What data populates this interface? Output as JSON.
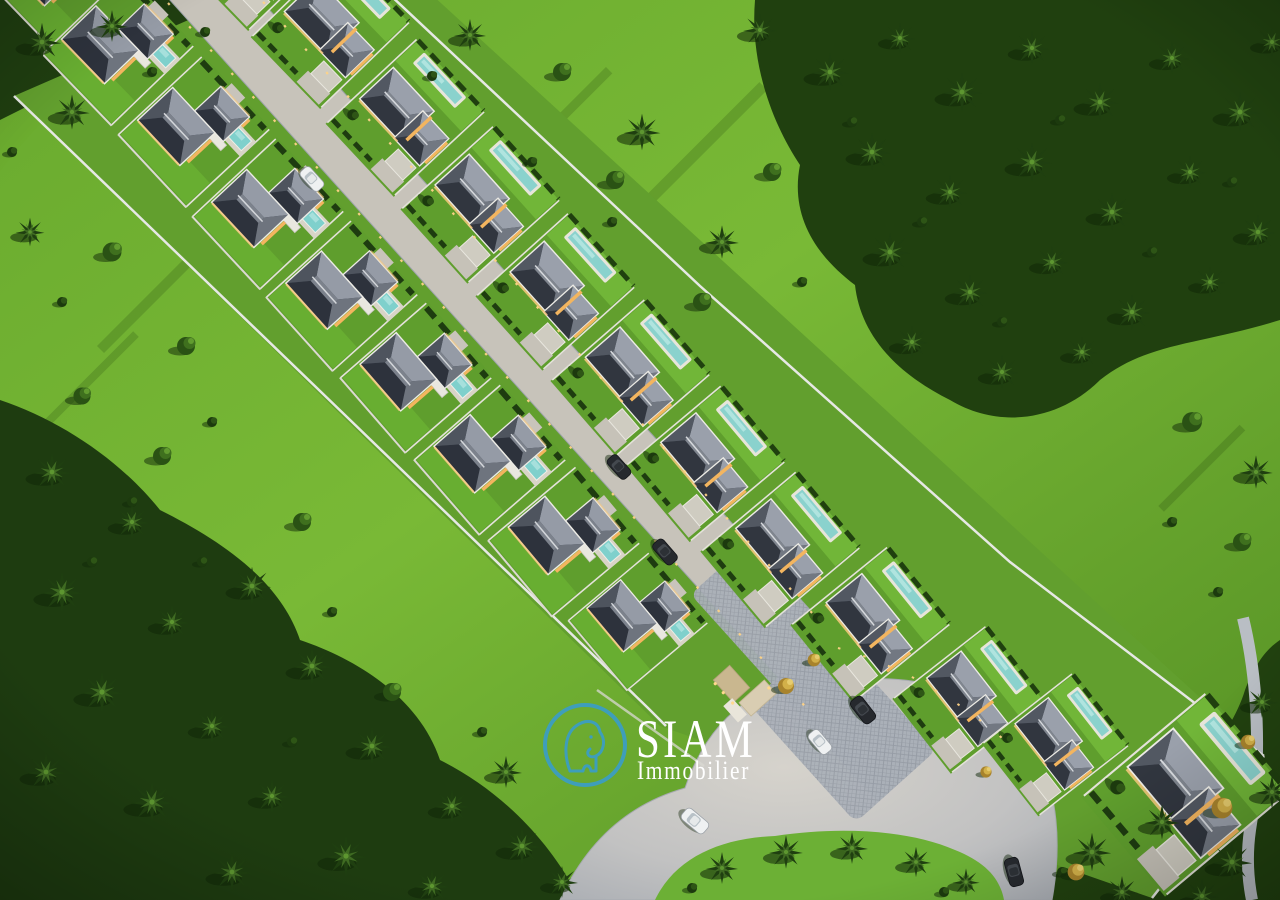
{
  "scene": {
    "type": "3d-aerial-architectural-render",
    "description": "Dusk aerial view of a gated tropical villa development: two rows of white pool villas with gray hip roofs along a central paved lane, an entry court with cars at the bottom, bright lawns and dense palm forest all around",
    "villa_rows": 2,
    "villas_visible_left_row": 9,
    "villas_visible_right_row": 11,
    "cars_visible": 7
  },
  "watermark": {
    "brand_name": "SIAM",
    "brand_subtitle": "Immobilier",
    "logo_icon": "elephant-circle-icon",
    "logo_stroke_color": "#3d9ec2",
    "text_color": "#ffffff"
  },
  "palette": {
    "lawn_bright": "#7cbe3a",
    "lawn_mid": "#5c9928",
    "forest_dark": "#1e3c10",
    "roof_highlight": "#959ba6",
    "roof_shadow": "#2d323c",
    "wall_white": "#ecebe5",
    "pool_teal": "#7fd0cc",
    "road_gray": "#c6c2b9",
    "paver_gray": "#aab0b8",
    "window_glow": "#f3b55f",
    "path_light": "#ffd387",
    "flower_tree": "#d2b049",
    "car_white": "#eff1f2",
    "car_dark": "#26292e"
  }
}
